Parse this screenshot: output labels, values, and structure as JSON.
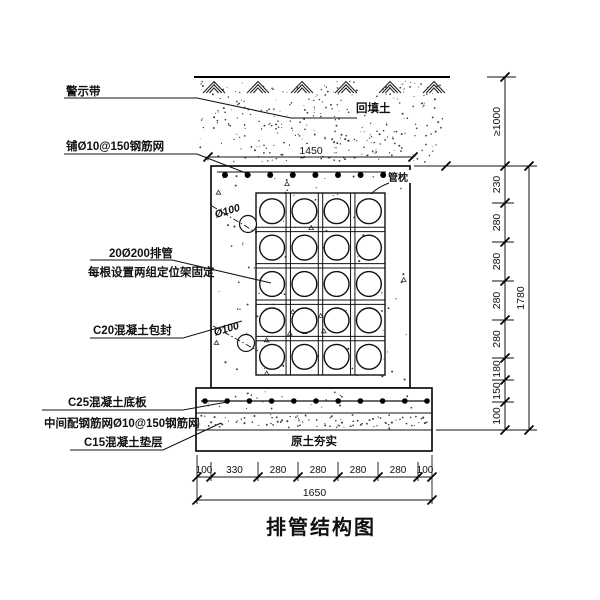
{
  "drawing": {
    "title": "排管结构图",
    "callouts": {
      "warning_tape": "警示带",
      "top_mesh": "铺Ø10@150钢筋网",
      "pipe_spec": "20Ø200排管",
      "pipe_fixing": "每根设置两组定位架固定",
      "encasement": "C20混凝土包封",
      "base_slab": "C25混凝土底板",
      "slab_mesh": "中间配钢筋网Ø10@150钢筋网",
      "cushion": "C15混凝土垫层"
    },
    "annotations": {
      "backfill_soil": "回填土",
      "pipe_pillow": "管枕",
      "compacted_soil": "原土夯实",
      "upper_drain": "Ø100",
      "lower_drain": "Ø100"
    },
    "dimensions": {
      "top_width": "1450",
      "bottom_segments": [
        "100",
        "330",
        "280",
        "280",
        "280",
        "280",
        "100"
      ],
      "bottom_total": "1650",
      "right_cover": "≥1000",
      "right_segments": [
        "230",
        "280",
        "280",
        "280",
        "280",
        "180",
        "150",
        "100"
      ],
      "right_total": "1780"
    },
    "pipes": {
      "rows": 5,
      "cols": 4
    }
  },
  "colors": {
    "line": "#111111",
    "background": "#ffffff"
  }
}
